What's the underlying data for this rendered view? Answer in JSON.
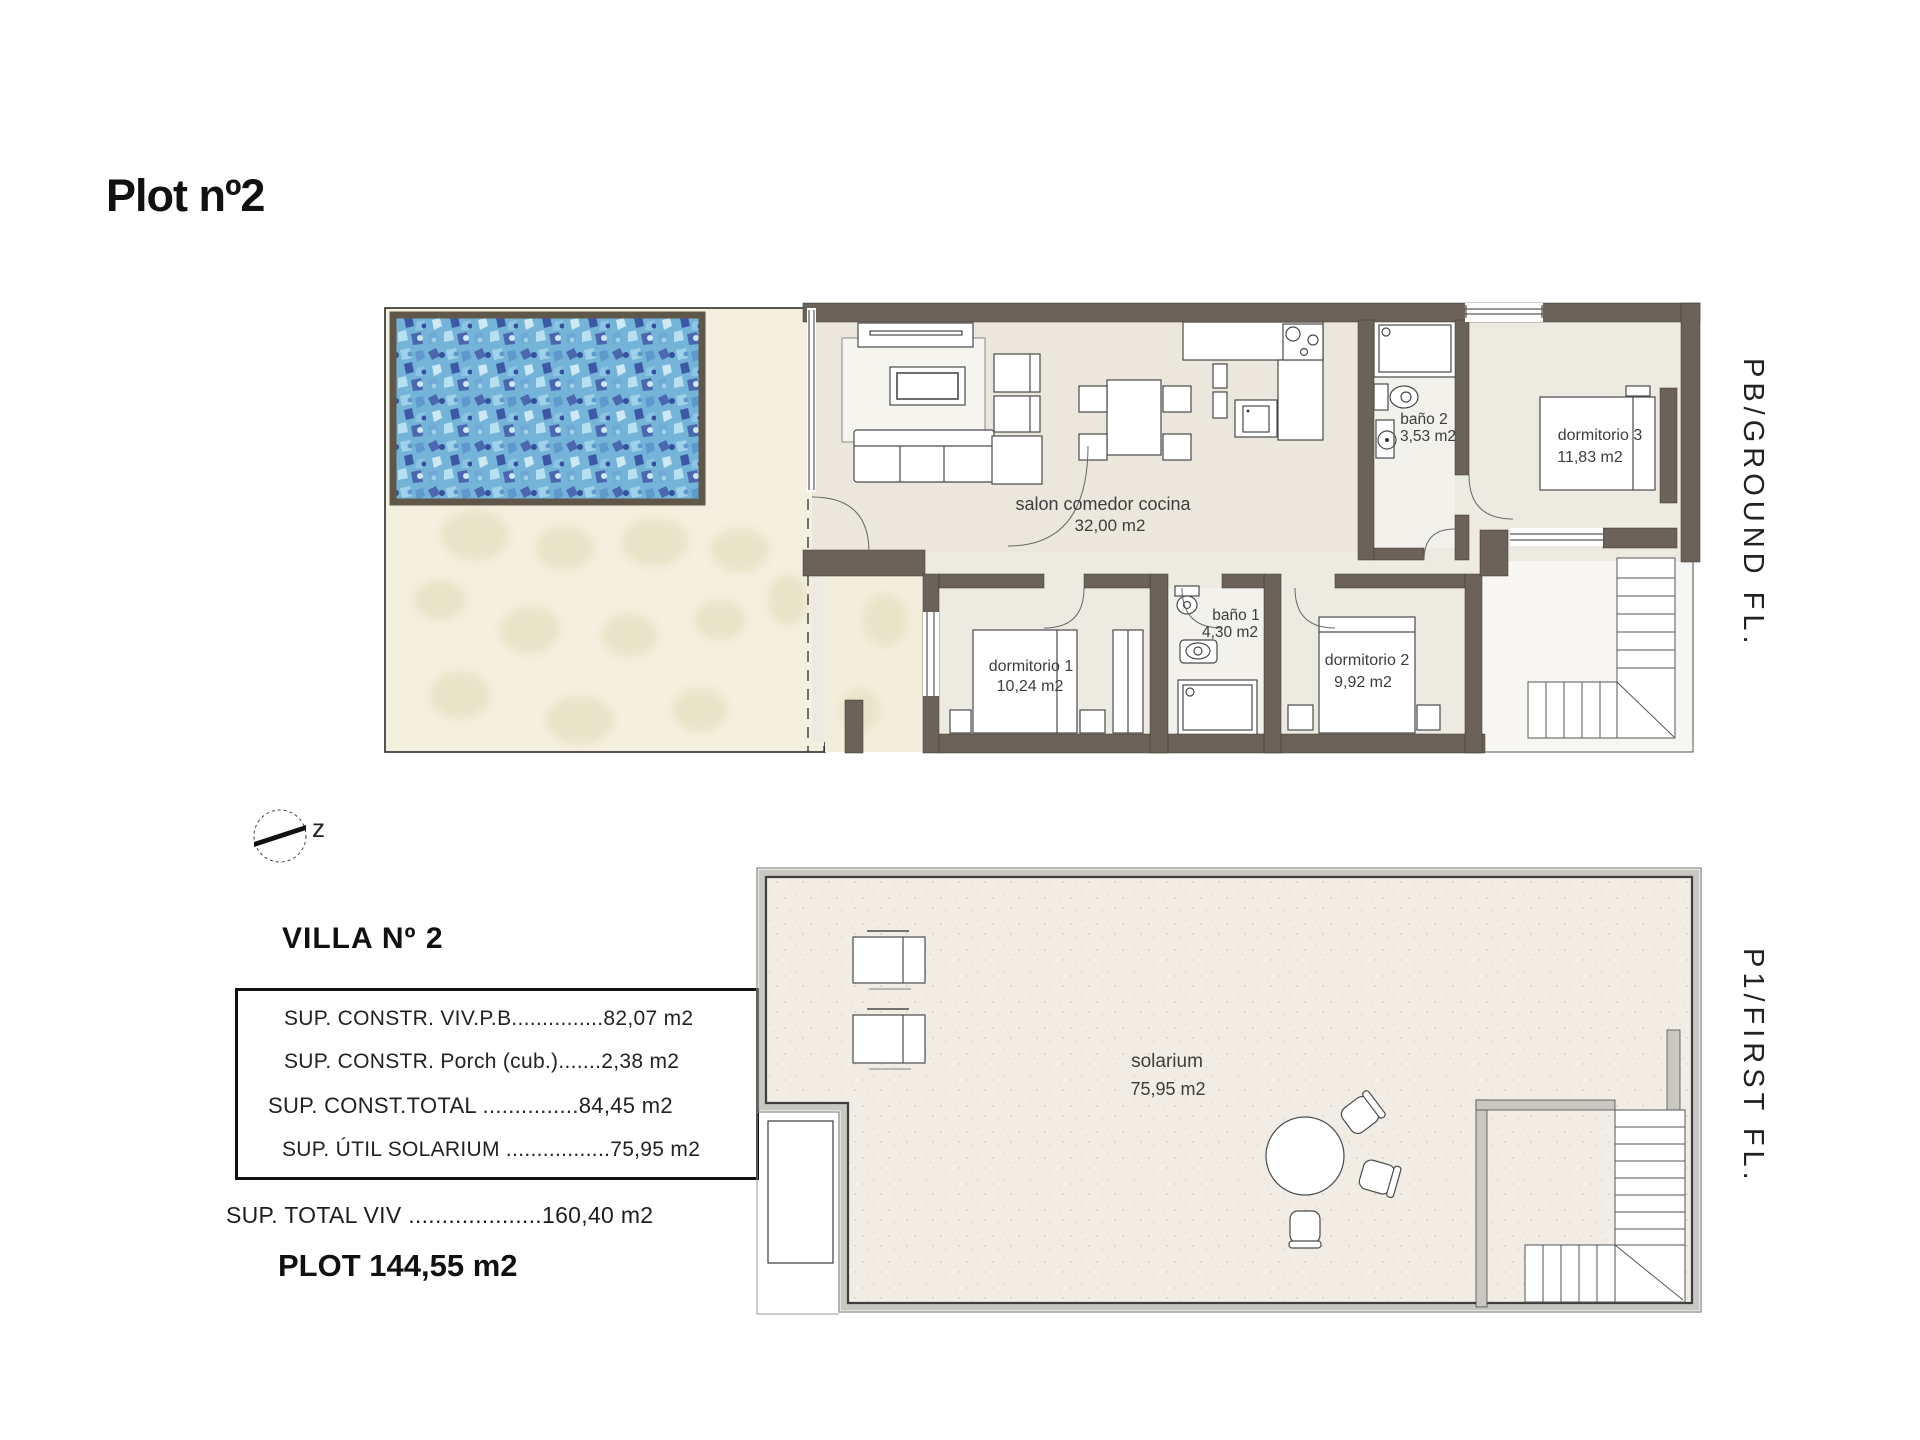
{
  "title": "Plot nº2",
  "floor_labels": {
    "ground": "PB/GROUND FL.",
    "first": "P1/FIRST FL."
  },
  "compass": {
    "north_label": "z"
  },
  "ground_floor": {
    "salon": {
      "name": "salon comedor cocina",
      "area": "32,00 m2"
    },
    "dormitorio1": {
      "name": "dormitorio 1",
      "area": "10,24 m2"
    },
    "bano1": {
      "name": "baño 1",
      "area": "4,30 m2"
    },
    "dormitorio2": {
      "name": "dormitorio 2",
      "area": "9,92 m2"
    },
    "bano2": {
      "name": "baño 2",
      "area": "3,53 m2"
    },
    "dormitorio3": {
      "name": "dormitorio 3",
      "area": "11,83 m2"
    }
  },
  "first_floor": {
    "solarium": {
      "name": "solarium",
      "area": "75,95 m2"
    }
  },
  "summary": {
    "heading": "VILLA Nº 2",
    "table_rows": [
      {
        "text": "SUP. CONSTR. VIV.P.B...............82,07 m2"
      },
      {
        "text": "SUP. CONSTR. Porch (cub.).......2,38 m2"
      },
      {
        "text": "SUP. CONST.TOTAL ...............84,45 m2"
      },
      {
        "text": "SUP. ÚTIL SOLARIUM .................75,95 m2"
      }
    ],
    "total_line": "SUP. TOTAL VIV ....................160,40 m2",
    "plot_line": "PLOT 144,55 m2"
  },
  "colors": {
    "wall_dark": "#6b6259",
    "pool_water_base": "#74b4d8",
    "pool_border": "#5f574a",
    "terrace": "#f4f0df",
    "interior_floor": "#edeae1",
    "first_floor_wall_band": "#c9c7c1",
    "line_dark": "#3a3a3a"
  }
}
